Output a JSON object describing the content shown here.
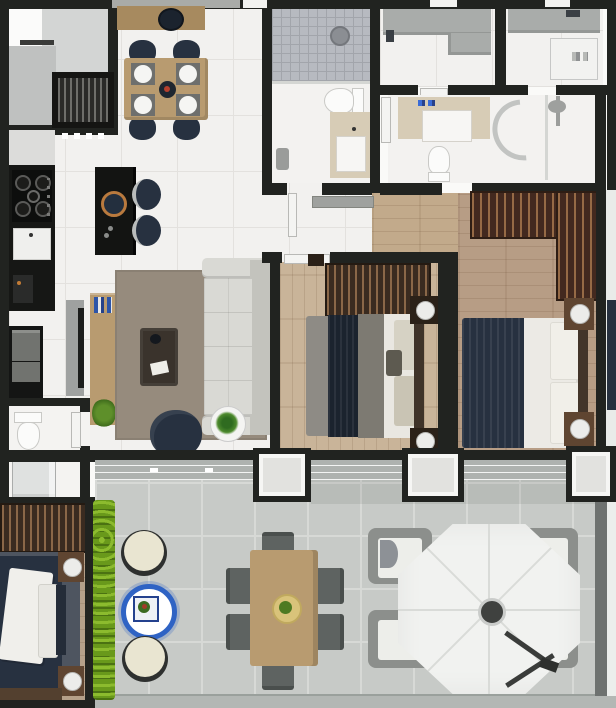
{
  "meta": {
    "title": "Apartment floor plan — top-down 3D render",
    "style": "photoreal rendered plan, no visible text labels"
  },
  "scene": {
    "rooms": [
      {
        "name": "common-hall",
        "position": "top-left outside unit",
        "furniture": [
          "slatted-cabinet"
        ]
      },
      {
        "name": "kitchen",
        "furniture": [
          "gas-stove",
          "sink",
          "coffee-machine",
          "oven-tower",
          "island-with-stools"
        ]
      },
      {
        "name": "dining-area",
        "furniture": [
          "sideboard",
          "wood-table",
          "four-navy-chairs",
          "four-place-settings"
        ]
      },
      {
        "name": "living-room",
        "furniture": [
          "tv-panel",
          "console-rack",
          "area-rug",
          "three-seat-sofa",
          "coffee-table",
          "navy-armchair",
          "potted-plant"
        ]
      },
      {
        "name": "social-bathroom",
        "furniture": [
          "shower",
          "toilet",
          "vanity",
          "waste-bin"
        ]
      },
      {
        "name": "service-area",
        "furniture": [
          "l-shaped-counter",
          "tap"
        ]
      },
      {
        "name": "laundry",
        "furniture": [
          "counter",
          "tap",
          "washer",
          "detergent-bottles"
        ]
      },
      {
        "name": "ensuite-bathroom",
        "furniture": [
          "vanity",
          "toilet",
          "curved-shower",
          "shower-head"
        ]
      },
      {
        "name": "hallway",
        "furniture": [
          "open-door-leaf"
        ]
      },
      {
        "name": "bedroom-1",
        "furniture": [
          "wardrobe",
          "double-bed-navy-throw",
          "two-nightstands-with-lamps"
        ]
      },
      {
        "name": "bedroom-2",
        "furniture": [
          "l-shaped-wardrobe",
          "double-bed-navy-and-white",
          "two-nightstands-with-lamps"
        ]
      },
      {
        "name": "bedroom-3",
        "furniture": [
          "wardrobe",
          "double-bed",
          "two-nightstands-with-lamps",
          "slate-rug"
        ]
      },
      {
        "name": "wc-shower",
        "furniture": [
          "toilet",
          "shower-box"
        ]
      },
      {
        "name": "balcony-terrace",
        "furniture": [
          "hedge-planter",
          "two-round-poufs",
          "blue-side-table",
          "outdoor-dining-table-six-chairs",
          "four-wicker-armchairs",
          "octagonal-parasol"
        ]
      }
    ]
  },
  "colors": {
    "wall": "#212320",
    "tile": "#f2f1ef",
    "tile_line": "#e3e1de",
    "wood_bed1": "#c9b499",
    "wood_bed2": "#b79d85",
    "wood_bed3": "#b5a089",
    "wood_hall": "#c2aa8b",
    "rug_living": "#968b7d",
    "slate_rug": "#4e5560",
    "sofa": "#d9d9d4",
    "sofa_dark": "#c3c3bd",
    "navy": "#273140",
    "navy_deep": "#1b232e",
    "counter_black": "#161715",
    "wood_furn": "#b89b70",
    "wood_sideboard": "#a78a5f",
    "nightstand_wood": "#5f4531",
    "wardrobe_dark": "#3a2b20",
    "wardrobe_red": "#43291f",
    "wardrobe_stripe": "#8a6748",
    "balcony_floor": "#c7cac7",
    "balcony_line": "#d7d9d6",
    "balcony_edge": "#b3b7b4",
    "hedge": "#69991b",
    "hedge_light": "#8cbb2e",
    "umbrella": "#f1f2f0",
    "umbrella_seam": "#d9dbd8",
    "outdoor_frame": "#8c8f8c",
    "outdoor_cushion": "#edeeea",
    "outdoor_chair_gray": "#5e6361",
    "cream_cushion": "#e9e5d1",
    "table_blue": "#2f63c4",
    "gray_counter": "#a9acaa",
    "vanity_beige": "#d7ccb6",
    "white_fixture": "#fbfbfa",
    "fixture_line": "#c9c9c6",
    "shower_tile": "#b7bac0",
    "shower_line": "#a2a5ab",
    "sill_gray": "#aeb2af",
    "door_white": "#f4f4f2",
    "neighbor_floor": "#d3d5d4",
    "neighbor_floor_dark": "#bfc1c0",
    "neighbor_right": "#e9ebe9",
    "lamp_white": "#ececea",
    "plant_green": "#3f7a2a",
    "plant_pot": "#f4f4f2",
    "copper": "#b97a3e",
    "tv_gray": "#9fa1a0",
    "steel": "#b9bcbb",
    "plate_white": "#f5f5f3",
    "placemat_gray": "#6e6f6d",
    "glass_gray": "#d4d6d3"
  }
}
